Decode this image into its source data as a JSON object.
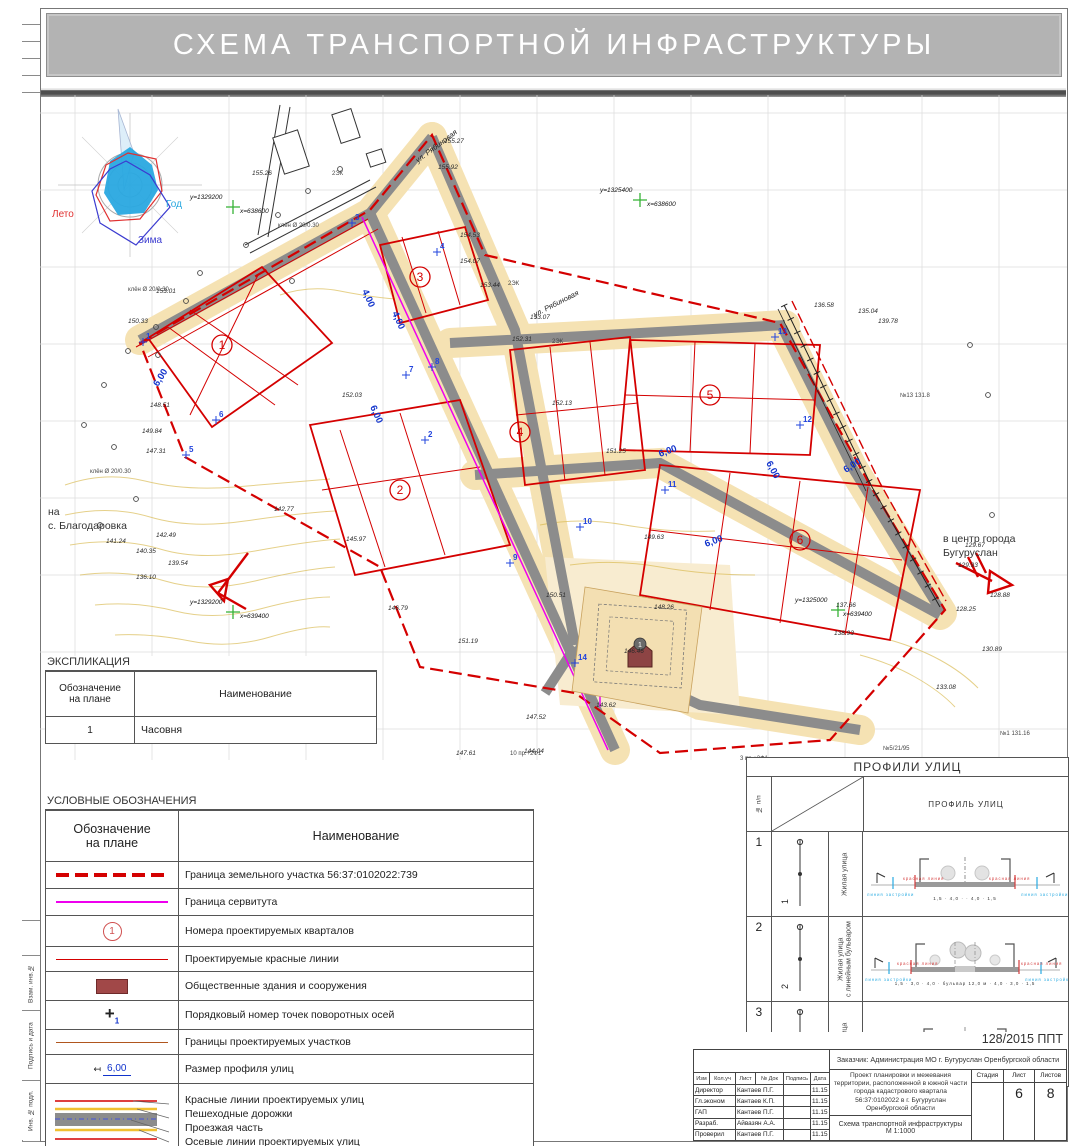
{
  "sheet": {
    "title": "СХЕМА ТРАНСПОРТНОЙ ИНФРАСТРУКТУРЫ"
  },
  "margin": {
    "labels": [
      "Взам. инв.№",
      "Подпись и дата",
      "Инв. № подл."
    ]
  },
  "map": {
    "texts": [
      {
        "t": "Лето",
        "x": 12,
        "y": 122,
        "c": "wl-red"
      },
      {
        "t": "Год",
        "x": 126,
        "y": 112,
        "c": "wl-cyan"
      },
      {
        "t": "Зима",
        "x": 98,
        "y": 148,
        "c": "wl-navy"
      },
      {
        "t": "у=1329200",
        "x": 150,
        "y": 104,
        "c": "coord"
      },
      {
        "t": "х=638600",
        "x": 200,
        "y": 118,
        "c": "coord"
      },
      {
        "t": "у=1325400",
        "x": 560,
        "y": 97,
        "c": "coord"
      },
      {
        "t": "х=638600",
        "x": 607,
        "y": 111,
        "c": "coord"
      },
      {
        "t": "у=1329200",
        "x": 150,
        "y": 509,
        "c": "coord"
      },
      {
        "t": "х=639400",
        "x": 200,
        "y": 523,
        "c": "coord"
      },
      {
        "t": "у=1325000",
        "x": 755,
        "y": 507,
        "c": "coord"
      },
      {
        "t": "х=639400",
        "x": 803,
        "y": 521,
        "c": "coord"
      },
      {
        "t": "ул. Рябиновая",
        "x": 378,
        "y": 68,
        "r": -37,
        "c": "st"
      },
      {
        "t": "ул. Рябиновая",
        "x": 495,
        "y": 222,
        "r": -27,
        "c": "st"
      },
      {
        "t": "на",
        "x": 8,
        "y": 420,
        "c": "rt"
      },
      {
        "t": "с. Благодаровка",
        "x": 8,
        "y": 434,
        "c": "rt"
      },
      {
        "t": "в центр города",
        "x": 903,
        "y": 447,
        "c": "rt"
      },
      {
        "t": "Бугуруслан",
        "x": 903,
        "y": 461,
        "c": "rt"
      },
      {
        "t": "6,00",
        "x": 118,
        "y": 292,
        "r": -58,
        "c": "dim"
      },
      {
        "t": "4,00",
        "x": 322,
        "y": 196,
        "r": 66,
        "c": "dim"
      },
      {
        "t": "4,00",
        "x": 352,
        "y": 218,
        "r": 66,
        "c": "dim"
      },
      {
        "t": "6,00",
        "x": 330,
        "y": 312,
        "r": 66,
        "c": "dim"
      },
      {
        "t": "6,00",
        "x": 620,
        "y": 362,
        "r": -20,
        "c": "dim"
      },
      {
        "t": "6,00",
        "x": 666,
        "y": 452,
        "r": -20,
        "c": "dim"
      },
      {
        "t": "6,00",
        "x": 726,
        "y": 368,
        "r": 62,
        "c": "dim"
      },
      {
        "t": "6,00",
        "x": 806,
        "y": 378,
        "r": -33,
        "c": "dim"
      },
      {
        "t": "2ЭК",
        "x": 292,
        "y": 80,
        "c": "nt"
      },
      {
        "t": "2ЭК",
        "x": 468,
        "y": 190,
        "c": "nt"
      },
      {
        "t": "2ЭК",
        "x": 512,
        "y": 248,
        "c": "nt"
      },
      {
        "t": "клён Ø 20/0.30",
        "x": 88,
        "y": 196,
        "c": "nt"
      },
      {
        "t": "клён Ø 20/0.30",
        "x": 238,
        "y": 132,
        "c": "nt"
      },
      {
        "t": "клён Ø 20/0.30",
        "x": 50,
        "y": 378,
        "c": "nt"
      },
      {
        "t": "3 пр.+2Ф1",
        "x": 700,
        "y": 665,
        "c": "nt"
      },
      {
        "t": "10 пр.+2Ф1",
        "x": 470,
        "y": 660,
        "c": "nt"
      },
      {
        "t": "№1 131.16",
        "x": 960,
        "y": 640,
        "c": "nt"
      },
      {
        "t": "№5/21/95",
        "x": 843,
        "y": 655,
        "c": "nt"
      },
      {
        "t": "№13 131.8",
        "x": 860,
        "y": 302,
        "c": "nt"
      },
      {
        "t": "1",
        "x": 600,
        "y": 552,
        "c": "chn"
      },
      {
        "t": "155.26",
        "x": 212,
        "y": 80
      },
      {
        "t": "155.27",
        "x": 404,
        "y": 48
      },
      {
        "t": "155.92",
        "x": 398,
        "y": 74
      },
      {
        "t": "154.53",
        "x": 420,
        "y": 142
      },
      {
        "t": "154.07",
        "x": 420,
        "y": 168
      },
      {
        "t": "153.44",
        "x": 440,
        "y": 192
      },
      {
        "t": "153.07",
        "x": 490,
        "y": 224
      },
      {
        "t": "152.31",
        "x": 472,
        "y": 246
      },
      {
        "t": "153.01",
        "x": 116,
        "y": 198
      },
      {
        "t": "152.03",
        "x": 302,
        "y": 302
      },
      {
        "t": "152.13",
        "x": 512,
        "y": 310
      },
      {
        "t": "151.25",
        "x": 566,
        "y": 358
      },
      {
        "t": "150.33",
        "x": 88,
        "y": 228
      },
      {
        "t": "149.84",
        "x": 102,
        "y": 338
      },
      {
        "t": "148.51",
        "x": 110,
        "y": 312
      },
      {
        "t": "147.31",
        "x": 106,
        "y": 358
      },
      {
        "t": "146.79",
        "x": 348,
        "y": 515
      },
      {
        "t": "145.97",
        "x": 306,
        "y": 446
      },
      {
        "t": "144.04",
        "x": 484,
        "y": 658
      },
      {
        "t": "143.62",
        "x": 556,
        "y": 612
      },
      {
        "t": "142.77",
        "x": 234,
        "y": 416
      },
      {
        "t": "142.49",
        "x": 116,
        "y": 442
      },
      {
        "t": "141.24",
        "x": 66,
        "y": 448
      },
      {
        "t": "140.35",
        "x": 96,
        "y": 458
      },
      {
        "t": "139.54",
        "x": 128,
        "y": 470
      },
      {
        "t": "138.93",
        "x": 794,
        "y": 540
      },
      {
        "t": "137.66",
        "x": 796,
        "y": 512
      },
      {
        "t": "136.10",
        "x": 96,
        "y": 484
      },
      {
        "t": "136.58",
        "x": 774,
        "y": 212
      },
      {
        "t": "135.04",
        "x": 818,
        "y": 218
      },
      {
        "t": "139.78",
        "x": 838,
        "y": 228
      },
      {
        "t": "133.08",
        "x": 896,
        "y": 594
      },
      {
        "t": "130.89",
        "x": 942,
        "y": 556
      },
      {
        "t": "129.93",
        "x": 918,
        "y": 472
      },
      {
        "t": "129.67",
        "x": 925,
        "y": 452
      },
      {
        "t": "128.88",
        "x": 950,
        "y": 502
      },
      {
        "t": "128.25",
        "x": 916,
        "y": 516
      },
      {
        "t": "151.19",
        "x": 418,
        "y": 548
      },
      {
        "t": "150.51",
        "x": 506,
        "y": 502
      },
      {
        "t": "149.63",
        "x": 604,
        "y": 444
      },
      {
        "t": "148.26",
        "x": 614,
        "y": 514
      },
      {
        "t": "147.52",
        "x": 486,
        "y": 624
      },
      {
        "t": "147.61",
        "x": 416,
        "y": 660
      },
      {
        "t": "146.46",
        "x": 584,
        "y": 558
      }
    ],
    "blocks": [
      {
        "n": "1",
        "x": 182,
        "y": 250
      },
      {
        "n": "2",
        "x": 360,
        "y": 395
      },
      {
        "n": "3",
        "x": 380,
        "y": 182
      },
      {
        "n": "4",
        "x": 480,
        "y": 337
      },
      {
        "n": "5",
        "x": 670,
        "y": 300
      },
      {
        "n": "6",
        "x": 760,
        "y": 445
      }
    ],
    "points": [
      {
        "n": "1",
        "x": 103,
        "y": 247
      },
      {
        "n": "2",
        "x": 385,
        "y": 345
      },
      {
        "n": "3",
        "x": 312,
        "y": 128
      },
      {
        "n": "4",
        "x": 397,
        "y": 157
      },
      {
        "n": "5",
        "x": 146,
        "y": 360
      },
      {
        "n": "6",
        "x": 176,
        "y": 325
      },
      {
        "n": "7",
        "x": 366,
        "y": 280
      },
      {
        "n": "8",
        "x": 392,
        "y": 272
      },
      {
        "n": "9",
        "x": 470,
        "y": 468
      },
      {
        "n": "10",
        "x": 540,
        "y": 432
      },
      {
        "n": "11",
        "x": 625,
        "y": 395
      },
      {
        "n": "12",
        "x": 760,
        "y": 330
      },
      {
        "n": "13",
        "x": 735,
        "y": 242
      },
      {
        "n": "14",
        "x": 535,
        "y": 568
      }
    ],
    "trees": [
      [
        64,
        290
      ],
      [
        88,
        256
      ],
      [
        116,
        232
      ],
      [
        146,
        206
      ],
      [
        44,
        330
      ],
      [
        74,
        352
      ],
      [
        268,
        96
      ],
      [
        300,
        74
      ],
      [
        238,
        120
      ],
      [
        206,
        150
      ],
      [
        160,
        178
      ],
      [
        118,
        260
      ],
      [
        252,
        186
      ],
      [
        930,
        250
      ],
      [
        948,
        300
      ],
      [
        952,
        420
      ],
      [
        96,
        404
      ],
      [
        60,
        430
      ]
    ]
  },
  "explication": {
    "title": "ЭКСПЛИКАЦИЯ",
    "col_mark": "Обозначение\nна плане",
    "col_name": "Наименование",
    "rows": [
      {
        "mark": "1",
        "name": "Часовня"
      }
    ]
  },
  "legend": {
    "title": "УСЛОВНЫЕ ОБОЗНАЧЕНИЯ",
    "col_mark": "Обозначение\nна плане",
    "col_name": "Наименование",
    "circle_symbol_text": "1",
    "cross_symbol": "+",
    "cross_symbol_sub": "1",
    "dim_symbol_text": "6,00",
    "rows": [
      {
        "label": "Граница земельного участка 56:37:0102022:739"
      },
      {
        "label": "Граница сервитута"
      },
      {
        "label": "Номера проектируемых кварталов"
      },
      {
        "label": "Проектируемые красные линии"
      },
      {
        "label": "Общественные здания и сооружения"
      },
      {
        "label": "Порядковый номер точек поворотных осей"
      },
      {
        "label": "Границы проектируемых участков"
      },
      {
        "label": "Размер профиля улиц"
      },
      {
        "label": "Красные линии проектируемых улиц\nПешеходные дорожки\nПроезжая часть\nОсевые линии проектируемых улиц"
      }
    ]
  },
  "profiles": {
    "panel_title": "ПРОФИЛИ УЛИЦ",
    "col_num": "№ п/п",
    "col_profile": "ПРОФИЛЬ УЛИЦ",
    "ann": {
      "red": "красная линия",
      "blue": "линия застройки"
    },
    "rows": [
      {
        "num": "1",
        "name": "Жилая улица",
        "dims": "1,5 · 4,0 · · 4,0 · 1,5"
      },
      {
        "num": "2",
        "name": "Жилая улица\nс линейным бульваром",
        "dims": "1,5 · 3,0 · 4,0 · бульвар 12,0 м · 4,0 · 3,0 · 1,5"
      },
      {
        "num": "3",
        "name": "Жилая улица",
        "dims": "1,5 · 6,0 · · 6,0 · 1,5"
      }
    ]
  },
  "titleblock": {
    "doc_number": "128/2015    ППТ",
    "customer": "Заказчик: Администрация МО г. Бугуруслан Оренбургской области",
    "cols": [
      "Изм",
      "Кол.уч",
      "Лист",
      "№ Док",
      "Подпись",
      "Дата"
    ],
    "signatures": [
      {
        "role": "Директор",
        "name": "Кантаев П.Г.",
        "date": "11.15"
      },
      {
        "role": "Гл.эконом",
        "name": "Кантаев К.П.",
        "date": "11.15"
      },
      {
        "role": "ГАП",
        "name": "Кантаев П.Г.",
        "date": "11.15"
      },
      {
        "role": "Разраб.",
        "name": "Айвазян А.А.",
        "date": "11.15"
      },
      {
        "role": "Проверил",
        "name": "Кантаев П.Г.",
        "date": "11.15"
      }
    ],
    "project": "Проект планировки и межевания территории, расположенной в южной части города кадастрового квартала 56:37:0102022 в г. Бугуруслан Оренбургской области",
    "stage_label": "Стадия",
    "sheet_label": "Лист",
    "sheets_label": "Листов",
    "stage_value": "",
    "sheet_value": "6",
    "sheets_value": "8",
    "drawing_title": "Схема транспортной инфраструктуры",
    "scale": "М 1:1000"
  },
  "colors": {
    "red_line": "#d40000",
    "servitude": "#ee00ee",
    "dim_blue": "#1133cc",
    "road_gray": "#8c8c8c",
    "sand": "#f5e2b3",
    "banner_gray": "#b3b3b3"
  }
}
